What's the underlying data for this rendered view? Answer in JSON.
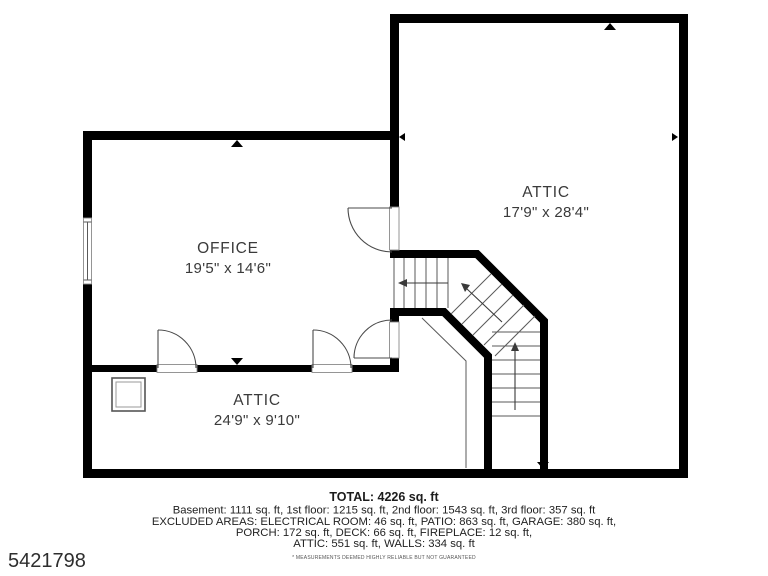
{
  "plan": {
    "rooms": [
      {
        "name": "ATTIC",
        "dims": "17'9\" x 28'4\""
      },
      {
        "name": "OFFICE",
        "dims": "19'5\" x 14'6\""
      },
      {
        "name": "ATTIC",
        "dims": "24'9\" x 9'10\""
      }
    ]
  },
  "footer": {
    "total": "TOTAL: 4226 sq. ft",
    "line1": "Basement: 1111 sq. ft, 1st floor: 1215 sq. ft, 2nd floor: 1543 sq. ft, 3rd floor: 357 sq. ft",
    "line2": "EXCLUDED AREAS: ELECTRICAL ROOM: 46 sq. ft, PATIO: 863 sq. ft, GARAGE: 380 sq. ft,",
    "line3": "PORCH: 172 sq. ft, DECK: 66 sq. ft, FIREPLACE: 12 sq. ft,",
    "line4": "ATTIC: 551 sq. ft, WALLS: 334 sq. ft",
    "disclaimer": "* MEASUREMENTS DEEMED HIGHLY RELIABLE BUT NOT GUARANTEED"
  },
  "listing_id": "5421798",
  "colors": {
    "wall": "#000000",
    "line": "#4a4a4a",
    "text": "#3a3a3a"
  }
}
